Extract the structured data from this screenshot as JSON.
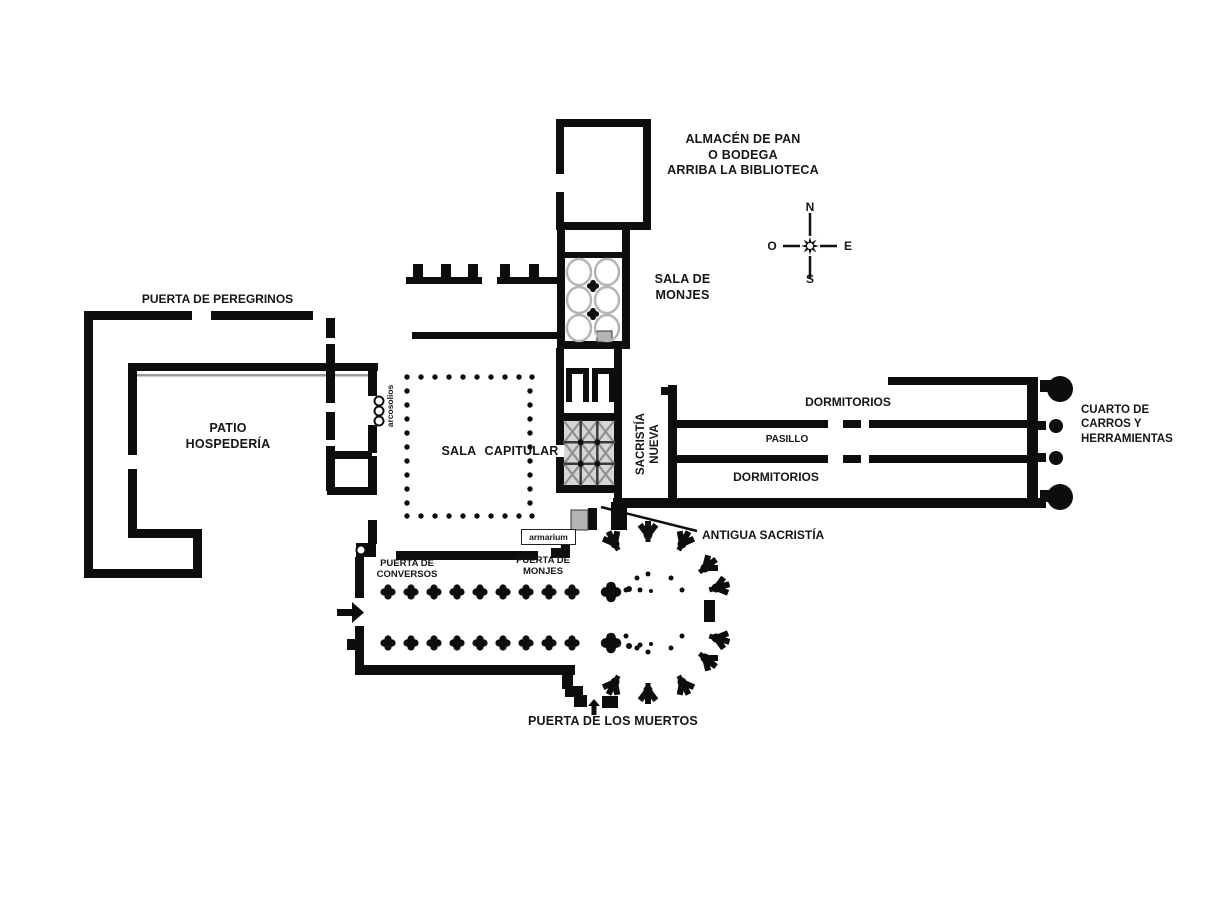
{
  "colors": {
    "wall": "#0d0d0d",
    "background": "#ffffff",
    "vault_outline": "#b5b5b5",
    "hatch_fill": "#b3b3b3",
    "vault_panel": "#d6d6d6"
  },
  "compass": {
    "north": "N",
    "south": "S",
    "east": "E",
    "west": "O"
  },
  "rooms": {
    "almacen": {
      "line1": "ALMACÉN DE PAN",
      "line2": "O BODEGA",
      "line3": "ARRIBA LA BIBLIOTECA"
    },
    "sala_monjes": {
      "line1": "SALA DE",
      "line2": "MONJES"
    },
    "patio": {
      "line1": "PATIO",
      "line2": "HOSPEDERÍA"
    },
    "sala_capitular": {
      "label": "SALA CAPITULAR"
    },
    "sacristia_nueva": {
      "line1": "SACRISTÍA",
      "line2": "NUEVA"
    },
    "dormitorios_norte": {
      "label": "DORMITORIOS"
    },
    "pasillo": {
      "label": "PASILLO"
    },
    "dormitorios_sur": {
      "label": "DORMITORIOS"
    },
    "cuarto_carros": {
      "line1": "CUARTO DE",
      "line2": "CARROS Y",
      "line3": "HERRAMIENTAS"
    },
    "antigua_sacristia": {
      "label": "ANTIGUA SACRISTÍA"
    },
    "armarium": {
      "label": "armarium"
    },
    "arcosolios": {
      "label": "arcosolios"
    }
  },
  "doors": {
    "peregrinos": {
      "label": "PUERTA DE PEREGRINOS"
    },
    "conversos": {
      "line1": "PUERTA DE",
      "line2": "CONVERSOS"
    },
    "monjes": {
      "line1": "PUERTA DE",
      "line2": "MONJES"
    },
    "muertos": {
      "label": "PUERTA DE LOS MUERTOS"
    }
  }
}
